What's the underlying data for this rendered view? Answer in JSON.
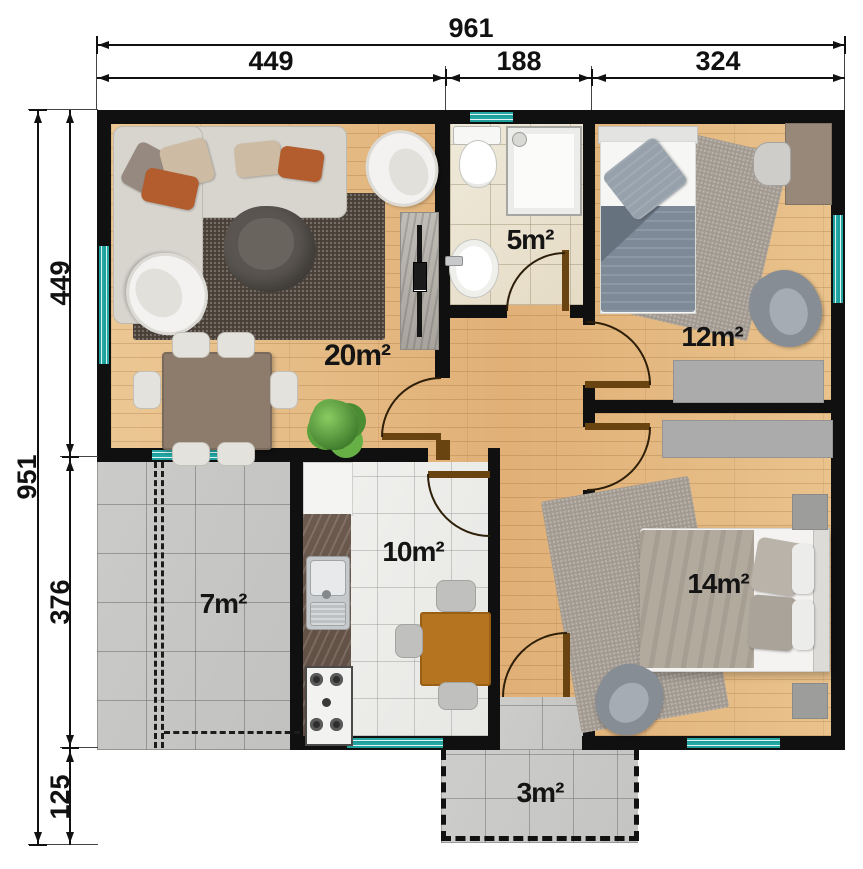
{
  "title": "Apartment floor plan",
  "dimensions": {
    "top_total": "961",
    "top_segments": [
      "449",
      "188",
      "324"
    ],
    "left_total": "951",
    "left_segments": [
      "449",
      "376",
      "125"
    ]
  },
  "rooms": {
    "living": {
      "area_label": "20m²"
    },
    "bathroom": {
      "area_label": "5m²"
    },
    "bedroom_small": {
      "area_label": "12m²"
    },
    "bedroom_large": {
      "area_label": "14m²"
    },
    "kitchen": {
      "area_label": "10m²"
    },
    "terrace": {
      "area_label": "7m²"
    },
    "porch": {
      "area_label": "3m²"
    }
  },
  "colors": {
    "wall": "#101010",
    "window_teal": "#25a7a3",
    "wood_floor": "#e7bd86",
    "door_leaf": "#6a4410",
    "bath_tile": "#ebe4d2",
    "kitchen_tile": "#efefed",
    "concrete_tile": "#c7c7c5"
  }
}
